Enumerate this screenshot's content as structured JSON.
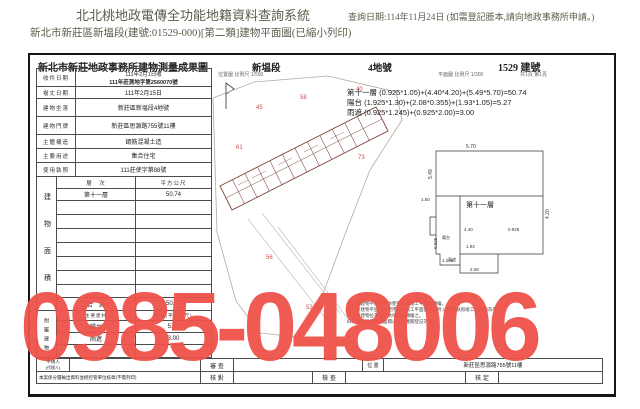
{
  "header": {
    "system_title": "北北桃地政電傳全功能地籍資料查詢系統",
    "subtitle": "新北市新莊區新塭段(建號:01529-000)[第二類]建物平面圖(已縮小列印)",
    "query_date": "查詢日期:114年11月24日 (如需登記謄本,請向地政事務所申請。)"
  },
  "doc": {
    "title": "新北市新莊地政事務所建物測量成果圖",
    "section": "新塭段",
    "land_no": "4地號",
    "building_no": "1529 建號",
    "scale_location": "位置圖 比例尺 1/500",
    "scale_plan": "平面圖 比例尺 1/300",
    "page_info": "共1頁 第1頁",
    "info_rows": [
      {
        "label": "收件日期",
        "line1": "111年2月1日收",
        "line2": "111年莊測地字第2560070號"
      },
      {
        "label": "複丈日期",
        "value": "111年2月15日"
      },
      {
        "label": "建物坐落",
        "value": "新莊區新塭段4地號"
      },
      {
        "label": "建物門牌",
        "value": "新莊區思源路755號11樓"
      },
      {
        "label": "主體構造",
        "value": "鋼筋混凝土造"
      },
      {
        "label": "主要用途",
        "value": "集合住宅"
      },
      {
        "label": "使用執照",
        "value": "111莊使字第88號"
      }
    ],
    "area_table": {
      "side_label": "建物面積",
      "col_floor": "層　次",
      "col_area": "平方公尺",
      "floor": "第十一層",
      "floor_area": "50.74",
      "total_label": "合　計",
      "total": "50.74"
    },
    "annex_table": {
      "side_label": "附屬建物",
      "col_name": "主要建材",
      "col_area": "面積(平方公尺)",
      "rows": [
        {
          "name": "陽台",
          "area": "5.27"
        },
        {
          "name": "雨遮",
          "area": "3.00"
        }
      ]
    },
    "formulas": {
      "line1": "第十一層 (0.925*1.05)+(4.40*4.20)+(5.49*5.70)=50.74",
      "line2": "陽台 (1.925*1.30)+(2.08*0.355)+(1.93*1.05)=5.27",
      "line3": "雨遮 (0.925*1.245)+(0.925*2.00)=3.00"
    },
    "detail": {
      "label": "第十一層",
      "d_top": "5.70",
      "d_left": "5.49",
      "d_right": "4.20",
      "w1": "4.40",
      "w2": "1.93",
      "w3": "1.245",
      "w4": "2.08",
      "s1": "0.925",
      "s2": "0.925",
      "s3": "1.50",
      "balcony": "陽台",
      "canopy": "雨遮"
    },
    "map": {
      "lot_numbers": [
        "45",
        "58",
        "40",
        "61",
        "73",
        "56",
        "52"
      ]
    },
    "notes": {
      "line1": "一、本建物平面圖係依使用執照竣工平面圖轉繪。",
      "line2": "二、本建物平面圖與使用執照竣工平面圖不符時,以使用執照竣工平面圖為準。",
      "line3": "三、本建物位置圖係依地籍圖轉繪之。",
      "line4": "四、本成果圖所載面積以登記機關登記為準。"
    },
    "footer": {
      "applicant": "申請人",
      "agent": "(代理人)",
      "review": "審 查",
      "check": "核 對",
      "inspect": "檢 查",
      "approve": "核 定",
      "position": "位 置",
      "address": "新莊區思源路755號11樓",
      "bottom_note": "本案係分層輸出資料並經控管單位核章(不需列印)"
    }
  },
  "overlay": {
    "phone": "0985-048006",
    "color": "#ef5349"
  }
}
